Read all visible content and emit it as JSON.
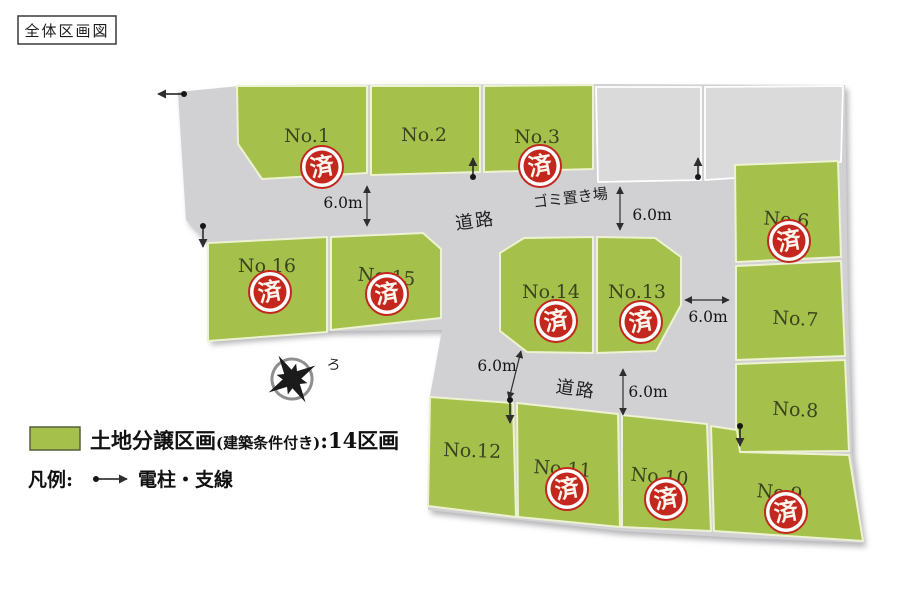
{
  "title": "全体区画図",
  "map": {
    "road_labels": [
      "道路",
      "道路"
    ],
    "garbage_label": "ゴミ置き場",
    "dimension_labels": [
      "6.0m",
      "6.0m",
      "6.0m",
      "6.0m",
      "6.0m"
    ],
    "sold_stamp": "済",
    "north_mark": "ろ",
    "lots": [
      {
        "label": "No.1",
        "sold": true
      },
      {
        "label": "No.2",
        "sold": false
      },
      {
        "label": "No.3",
        "sold": true
      },
      {
        "label": "No.6",
        "sold": true
      },
      {
        "label": "No.7",
        "sold": false
      },
      {
        "label": "No.8",
        "sold": false
      },
      {
        "label": "No.9",
        "sold": true
      },
      {
        "label": "No.10",
        "sold": true
      },
      {
        "label": "No.11",
        "sold": true
      },
      {
        "label": "No.12",
        "sold": false
      },
      {
        "label": "No.13",
        "sold": true
      },
      {
        "label": "No.14",
        "sold": true
      },
      {
        "label": "No.15",
        "sold": true
      },
      {
        "label": "No.16",
        "sold": true
      }
    ]
  },
  "legend": {
    "zone_main": "土地分譲区画",
    "zone_note": "(建築条件付き)",
    "zone_count": ":14区画",
    "key_label": "凡例:",
    "pole_label": "電柱・支線"
  },
  "colors": {
    "lot_green": "#a5c04b",
    "road_gray": "#d1d1d4",
    "parcel_gray": "#dadadb",
    "stamp_red": "#c3271d",
    "lot_label_green": "#3c431f"
  }
}
